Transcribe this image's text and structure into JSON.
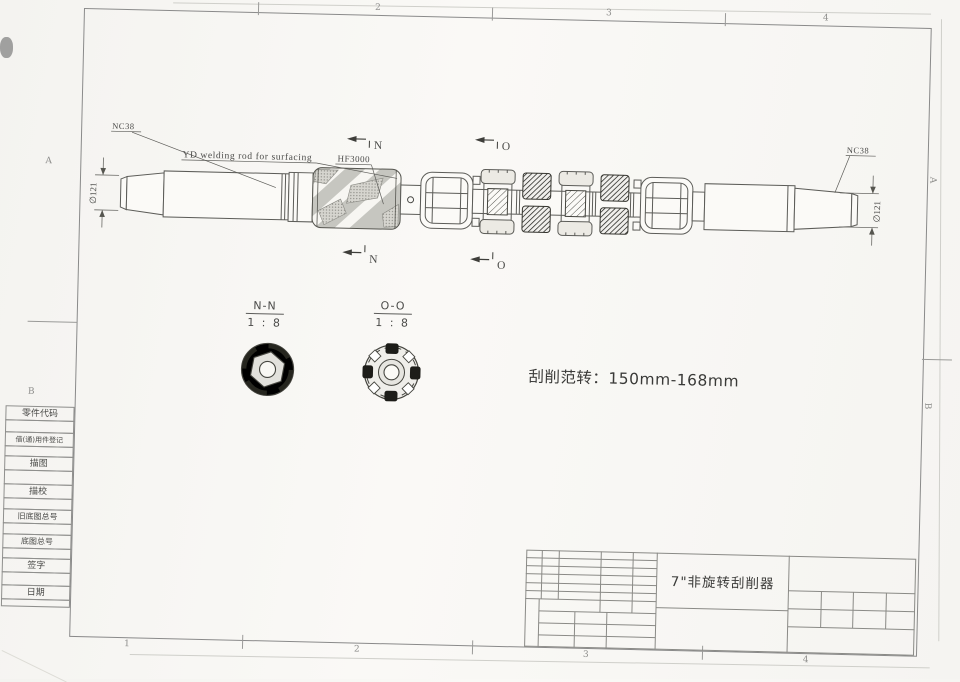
{
  "drawing": {
    "note": "刮削范转：150mm-168mm",
    "title": "7\"非旋转刮削器",
    "labels": {
      "nc38_left": "NC38",
      "nc38_right": "NC38",
      "dia_left": "∅121",
      "dia_right": "∅121",
      "welding_note": "YD welding rod for surfacing",
      "hardfacing": "HF3000",
      "section_n": "N",
      "section_o": "O"
    },
    "sections": {
      "nn_label": "N-N",
      "nn_scale": "1 : 8",
      "oo_label": "O-O",
      "oo_scale": "1 : 8"
    },
    "sidebar_items": [
      "零件代码",
      "借(通)用件登记",
      "描图",
      "描校",
      "旧底图总号",
      "底图总号",
      "签字",
      "日期"
    ],
    "zones": {
      "top": [
        "2",
        "3",
        "4"
      ],
      "bottom": [
        "1",
        "2",
        "3",
        "4"
      ],
      "left": [
        "A",
        "B"
      ],
      "right": [
        "A",
        "B"
      ]
    }
  }
}
